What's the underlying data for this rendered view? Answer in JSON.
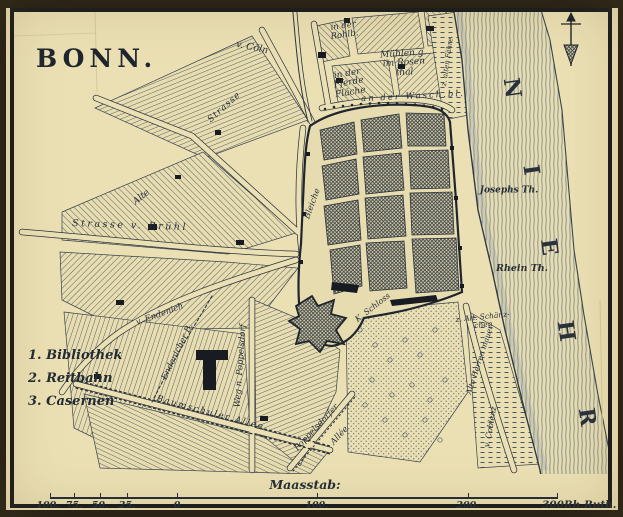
{
  "title": "BONN.",
  "legend": {
    "items": [
      "1. Bibliothek",
      "2. Reitbahn",
      "3. Casernen"
    ]
  },
  "scale": {
    "caption": "Maasstab:",
    "tick_labels": [
      "100.",
      "75.",
      "50.",
      "25.",
      "0",
      "100.",
      "200.",
      "300"
    ],
    "unit": "Rh.Ruth."
  },
  "river": {
    "name": "RHEIN",
    "letters": [
      "R",
      "H",
      "E",
      "I",
      "N"
    ]
  },
  "compass": {
    "icon": "north-arrow"
  },
  "map_labels": {
    "von_coeln": "v. Cöln",
    "in_der_rohlb": [
      "in der",
      "Rohlb."
    ],
    "muehlen": [
      "Mühlen g.",
      "im Rosen",
      "thal"
    ],
    "pferde_flaeche": [
      "in der",
      "Pferde",
      "Fläche"
    ],
    "wasch_bleiche": "an der Wasch.bl.",
    "strasse": "Strasse",
    "alte": "Alte",
    "strasse_v_bruehl": "Strasse v. Brühl",
    "von_endenich": "v. Endenich",
    "endenicher_b": "Endenicher B.",
    "baumschuler_allee": "Baumschuler Allee",
    "weg_n_poppelsdorf": "Weg n. Poppelsdorf",
    "poppelsdorfer": "Poppelsdorfer",
    "allee": "Allée",
    "bleiche": "Bleiche",
    "k_schloss": "K. Schloss",
    "josephs_th": "Josephs Th.",
    "rhein_th": "Rhein Th.",
    "schaenzchen": [
      "z. Alt. Schänz-",
      "chen"
    ],
    "herren_mauer": "Alte Herren mauer",
    "coblenz": "v. Coblenz",
    "faehre": "z. alten Fähre"
  },
  "colors": {
    "paper": "#ebe0b4",
    "ink": "#2b333d"
  }
}
